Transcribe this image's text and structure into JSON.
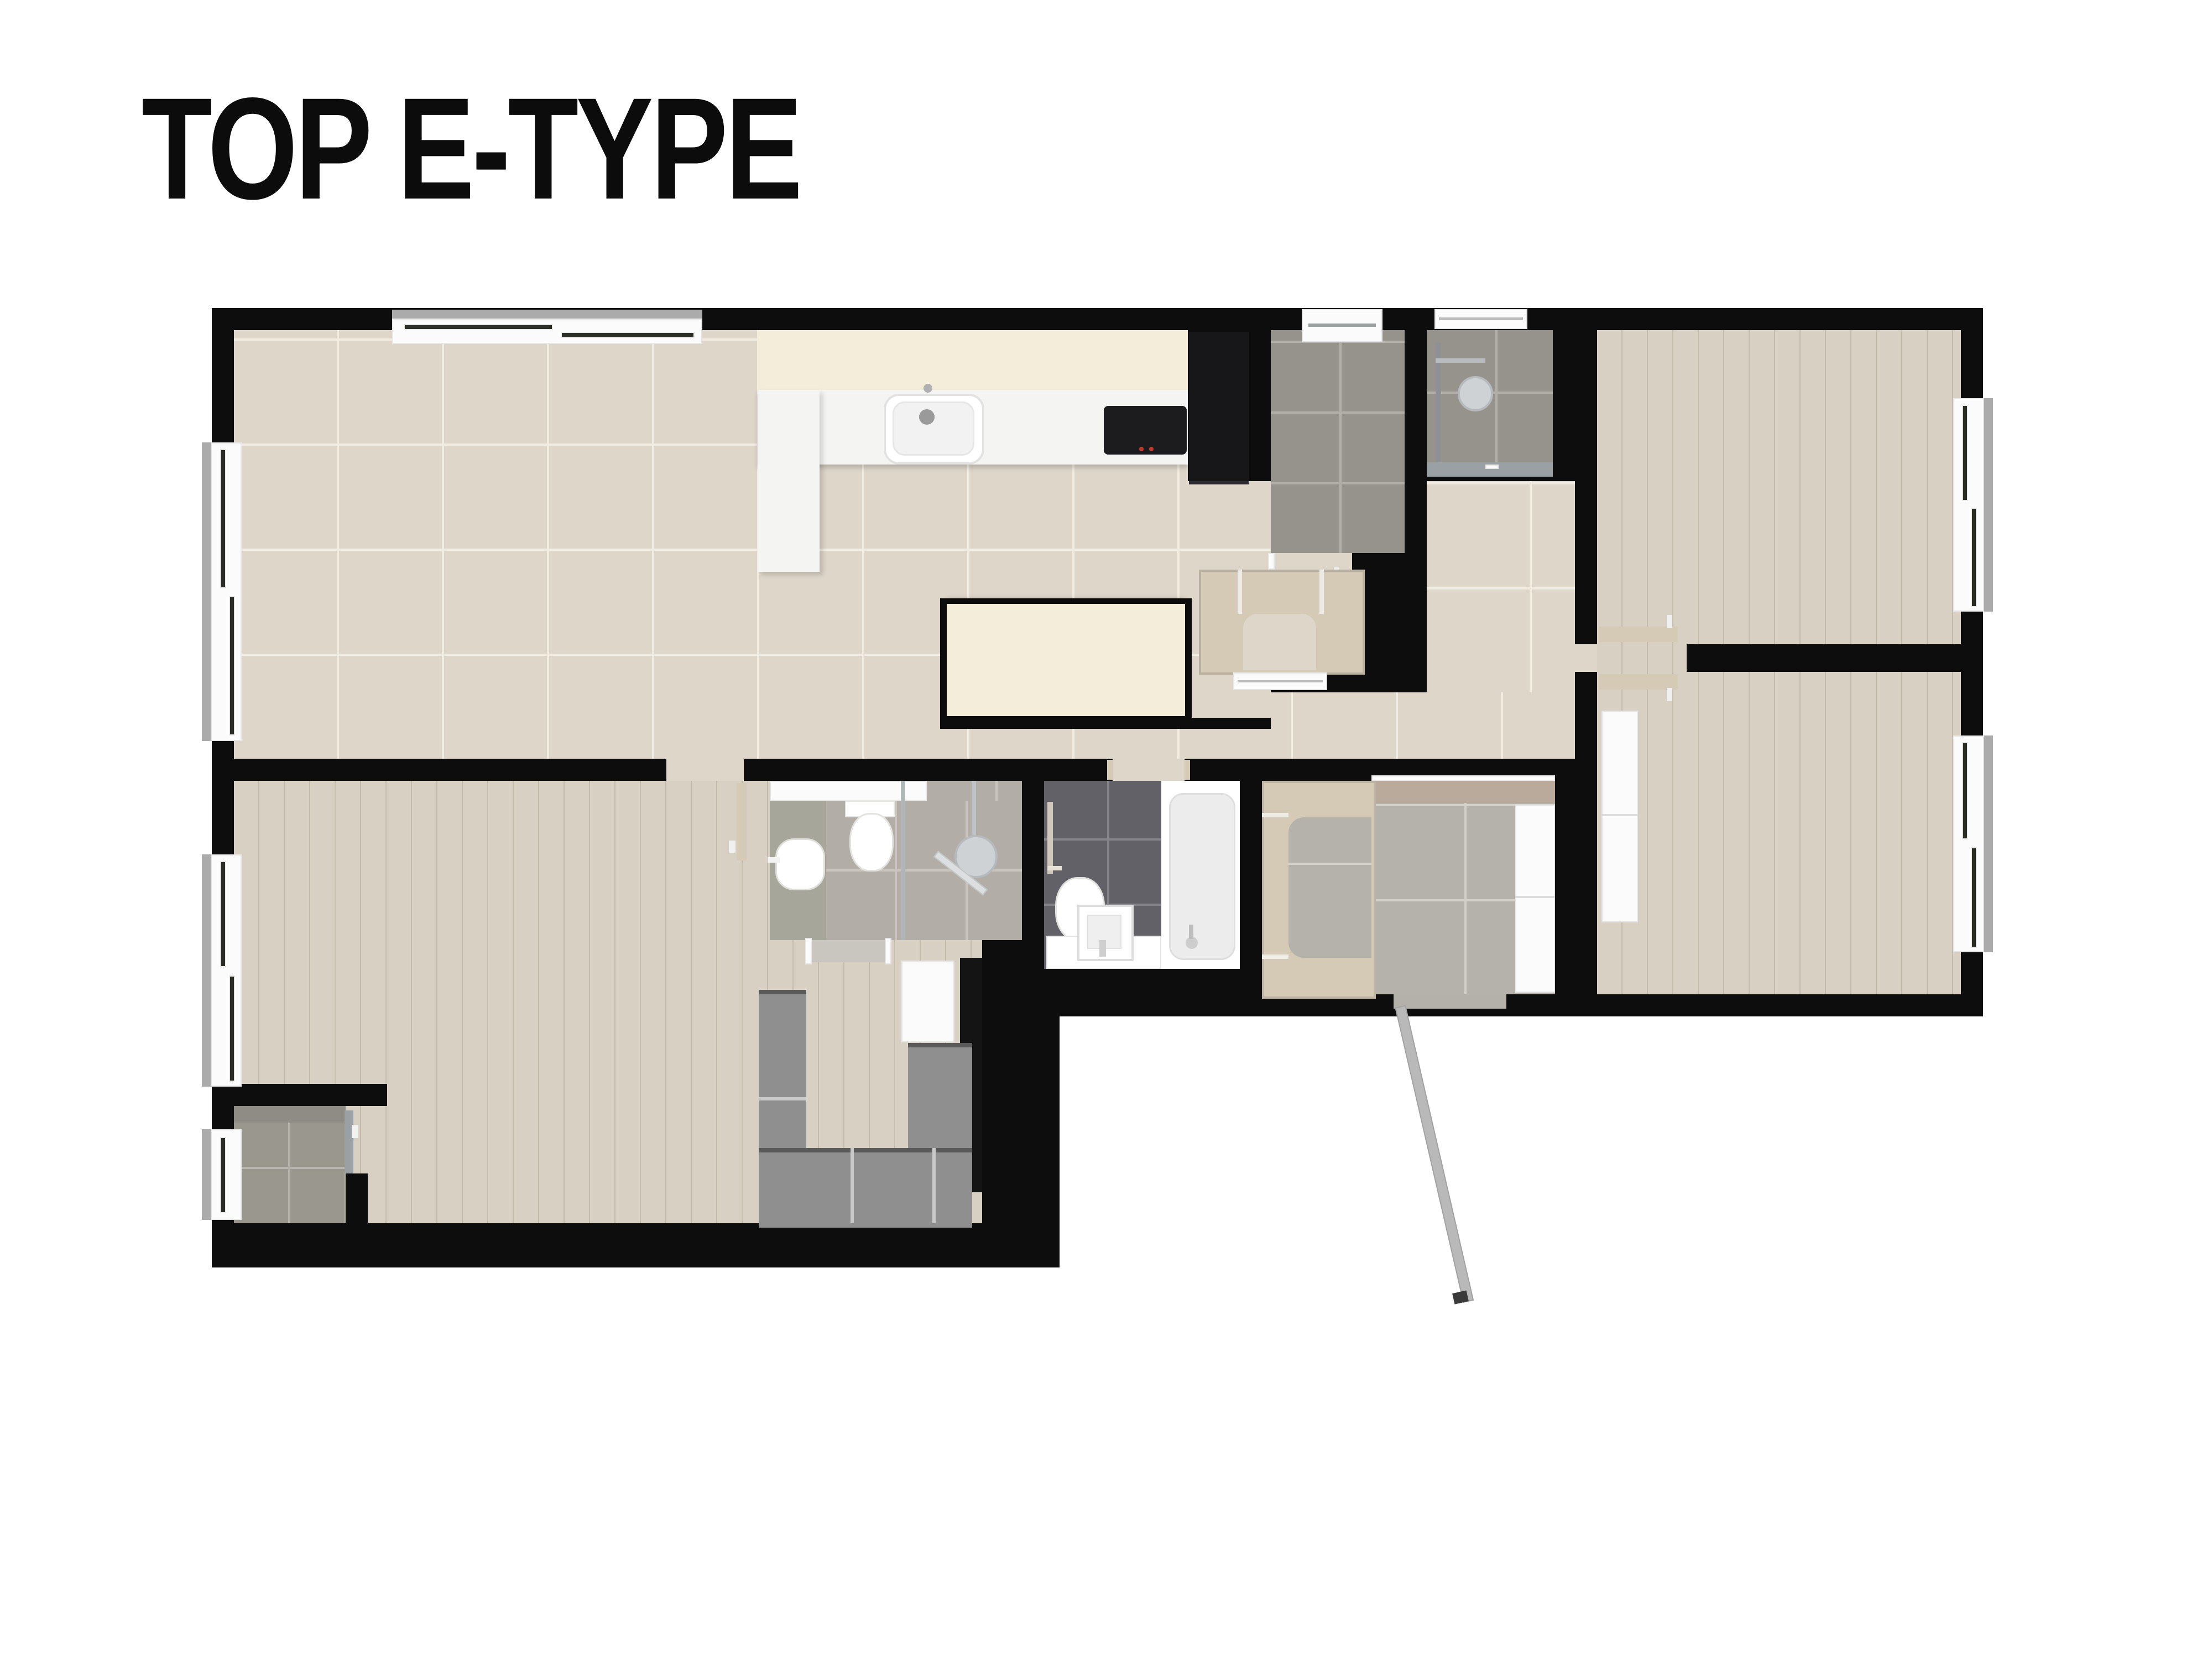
{
  "title": "TOP E-TYPE",
  "palette": {
    "wall": "#0d0d0d",
    "white": "#fbfbfb",
    "cream": "#f3edda",
    "counter": "#f4f4f2",
    "beige": "#ddd6c9",
    "beigeLine": "#f0ece2",
    "wood": "#d8d1c3",
    "gray": "#96928c",
    "grayLine": "#b3afa9",
    "bathLight": "#b2aea7",
    "bathLightLine": "#c9c5be",
    "bathDark": "#616167",
    "bathDarkLine": "#84848a",
    "speckle": "#b5b2ac",
    "speckleLine": "#d3d0ca",
    "terrazzo": "#a6a69b",
    "tan": "#d4cab6",
    "mat": "#b9aa9b",
    "wardrobe": "#8f8f8f",
    "wardrobeLine": "#c9c9c9",
    "wardrobeTop": "#5a5a5a",
    "glass": "#9aa0a4",
    "fridge": "#17171a",
    "cook": "#1c1c1f",
    "threshold": "#c9c6c0",
    "sill": "#ababab",
    "balc": "#9a978f",
    "balcLine": "#b7b4ae",
    "doorleaf": "#d4cab6",
    "unit": "#141414"
  },
  "rooms": [
    "living-dining-kitchen",
    "hallway",
    "utility-room",
    "pantry-storage",
    "wet-room",
    "bedroom-top-right",
    "bedroom-bottom-right",
    "ensuite-bathroom",
    "family-bathroom",
    "entry-vestibule",
    "walk-in-closet",
    "master-bedroom",
    "balcony"
  ],
  "fixtures": [
    "kitchen-sink",
    "kitchen-faucet",
    "cooktop",
    "kitchen-island",
    "refrigerator",
    "washer-unit",
    "shower-column",
    "shower-head",
    "grab-bar",
    "toilet",
    "vanity-sink",
    "square-sink",
    "bathtub",
    "tub-faucet",
    "towel-bar",
    "glass-partition",
    "sliding-door",
    "door-leaf",
    "entry-door",
    "door-mat",
    "shoe-closet",
    "wardrobe-unit",
    "window"
  ]
}
